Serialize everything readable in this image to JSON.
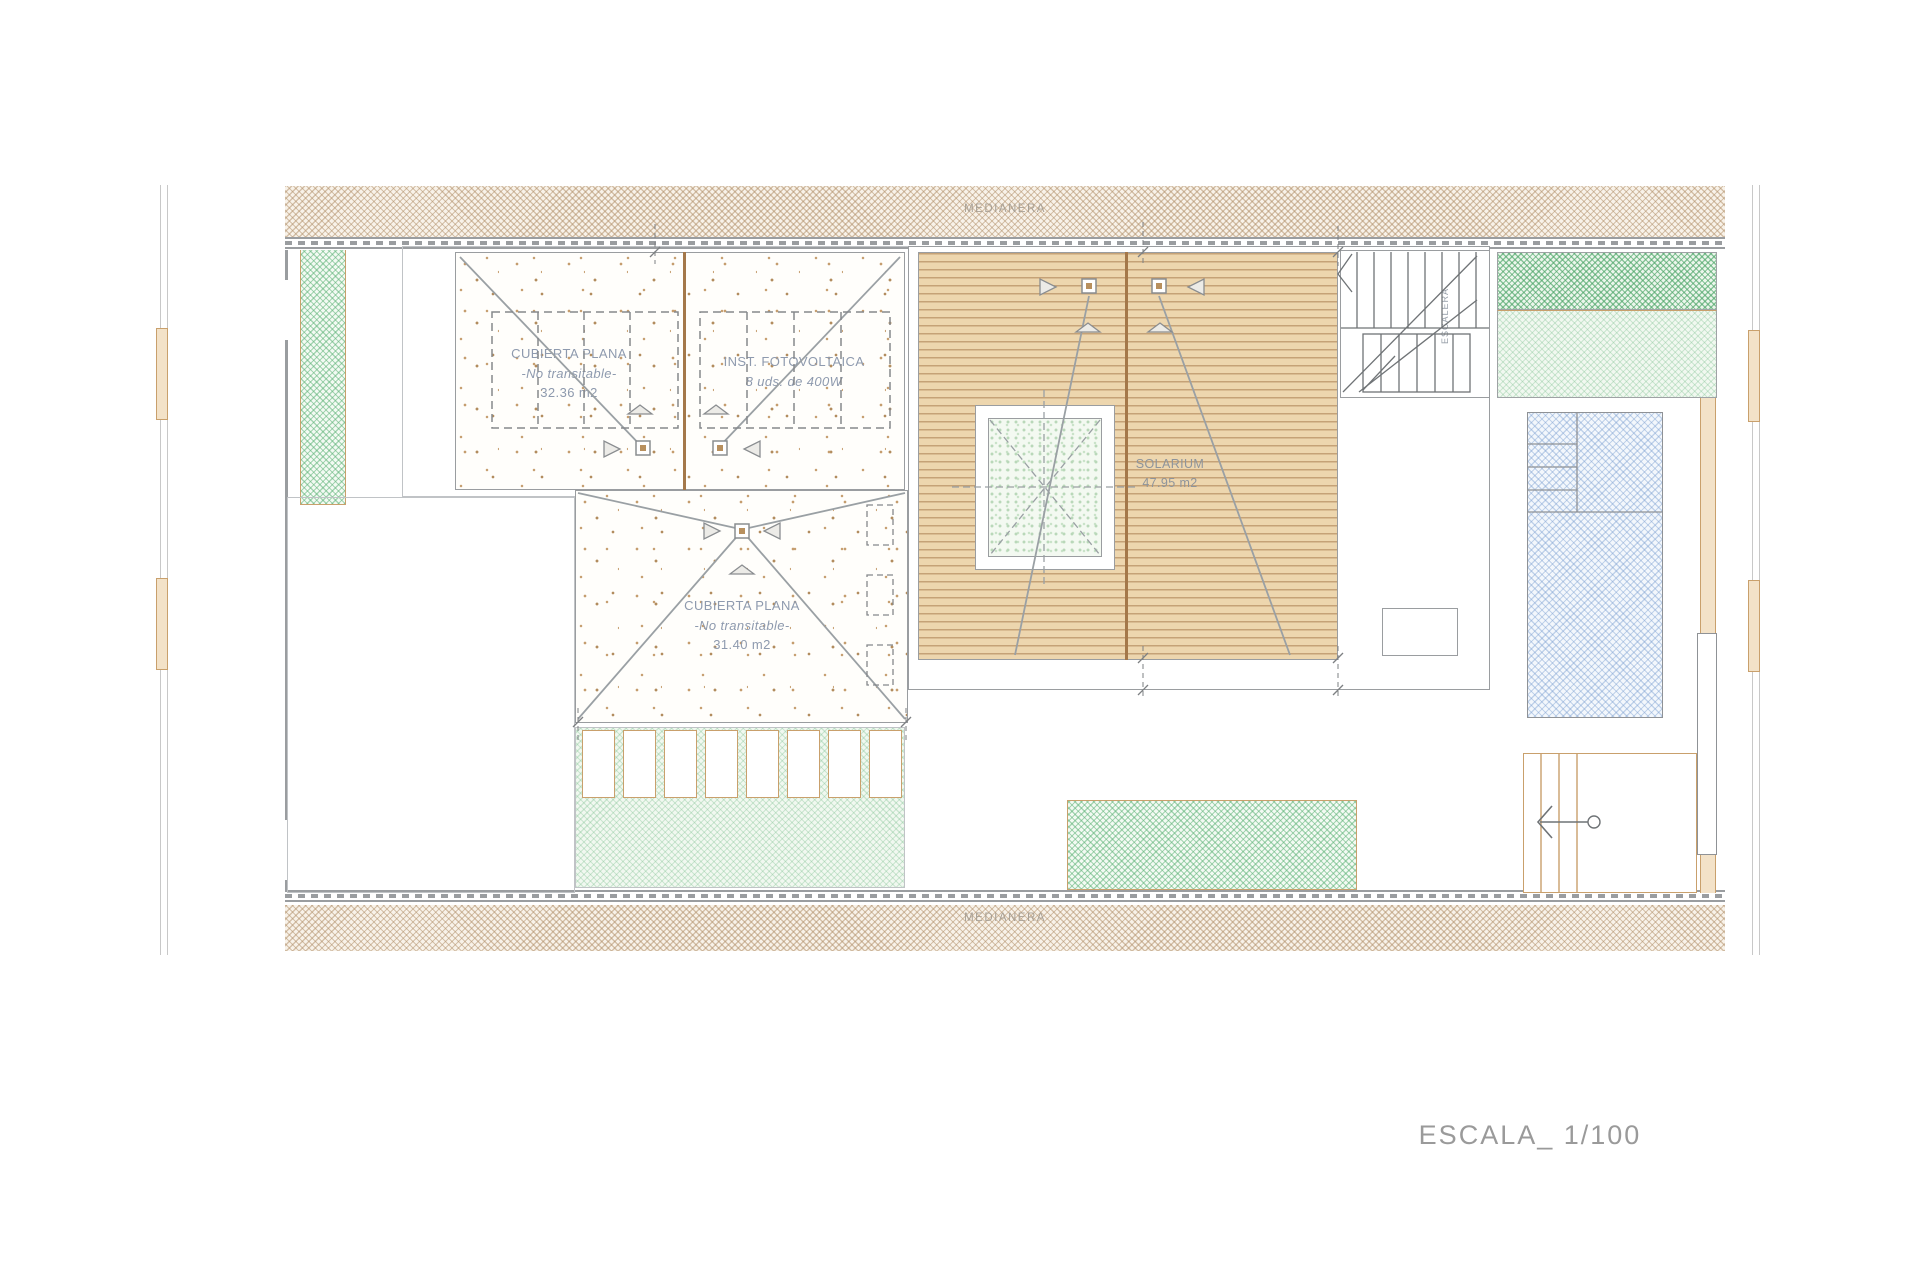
{
  "drawing": {
    "scale_label": "ESCALA_ 1/100",
    "party_wall_top": "MEDIANERA",
    "party_wall_bottom": "MEDIANERA",
    "flat_roof_left": {
      "title": "CUBIERTA PLANA",
      "subtitle": "-No transitable-",
      "area": "32.36 m2"
    },
    "photovoltaic": {
      "title": "INST. FOTOVOLTAICA",
      "subtitle": "8 uds. de 400W"
    },
    "flat_roof_center": {
      "title": "CUBIERTA PLANA",
      "subtitle": "-No transitable-",
      "area": "31.40 m2"
    },
    "solarium": {
      "title": "SOLARIUM",
      "area": "47.95 m2"
    },
    "stair_label": "ESCALERA",
    "colors": {
      "party_wall_hatch": "#b08e68",
      "deck_wood": "#edd6ae",
      "deck_line": "#a4784a",
      "vegetation_green": "#5cb276",
      "pool_blue": "#7a9ed0",
      "drawing_line": "#9a9da0",
      "label_text": "#8e9aae",
      "scale_text": "#9a9a9a"
    }
  }
}
